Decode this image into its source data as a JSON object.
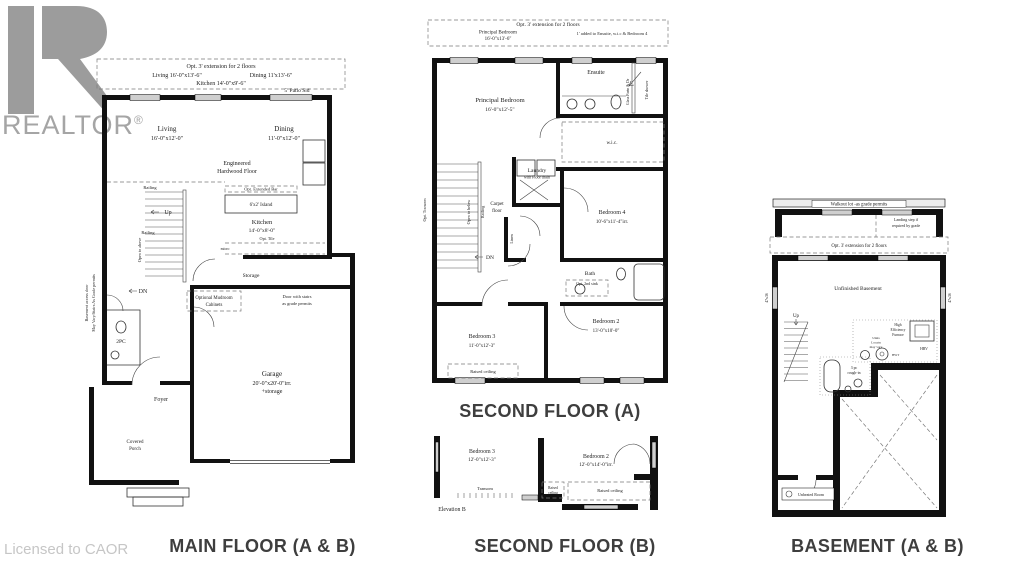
{
  "watermark": {
    "brand": "REALTOR",
    "reg": "®",
    "license": "Licensed to CAOR"
  },
  "captions": {
    "main": "MAIN FLOOR (A & B)",
    "second_a": "SECOND FLOOR (A)",
    "second_b": "SECOND FLOOR (B)",
    "basement": "BASEMENT (A & B)"
  },
  "main": {
    "opt_extension": "Opt. 3' extension for 2 floors",
    "opt_living": "Living 16'-0\"x13'-6\"",
    "opt_dining": "Dining 11'x13'-6\"",
    "opt_kitchen": "Kitchen 14'-0\"x9'-6\"",
    "patio": "5' Patio Sld",
    "living_name": "Living",
    "living_dim": "16'-0\"x12'-0\"",
    "dining_name": "Dining",
    "dining_dim": "11'-0\"x12'-0\"",
    "floor_1": "Engineered",
    "floor_2": "Hardwood Floor",
    "opt_bar": "Opt. Extended Bar",
    "island": "6'x2' Island",
    "kitchen_name": "Kitchen",
    "kitchen_dim": "14'-0\"x8'-0\"",
    "opt_tile": "Opt. Tile",
    "micro": "micro",
    "up": "Up",
    "dn": "DN",
    "railing_1": "Railing",
    "railing_2": "Railing",
    "open_above": "Open to above",
    "side_note_1": "Basement access door",
    "side_note_2": "May Vary/Stairs As Grade permits",
    "powder": "2PC",
    "mudroom_1": "Optional Mudroom",
    "mudroom_2": "Cabinets",
    "storage": "Storage",
    "door_note_1": "Door with stairs",
    "door_note_2": "as grade permits",
    "garage_name": "Garage",
    "garage_dim": "20'-0\"x20'-0\"irr.",
    "garage_dim2": "+storage",
    "foyer": "Foyer",
    "porch_1": "Covered",
    "porch_2": "Porch"
  },
  "second_a": {
    "opt_extension": "Opt. 3' extension for 2 floors",
    "opt_pb_1": "Principal Bedroom",
    "opt_pb_2": "16'-0\"x13'-6\"",
    "opt_added": "1' added to Ensuite, w.i.c & Bedroom 4",
    "principal_name": "Principal Bedroom",
    "principal_dim": "16'-0\"x12'-5\"",
    "ensuite": "Ensuite",
    "glass_partn": "Glass Partn & Dr",
    "tile_shower": "Tile shower",
    "wic": "w.i.c.",
    "laundry_1": "Laundry",
    "laundry_2": "with Floor drain",
    "carpet_1": "Carpet",
    "carpet_2": "floor",
    "open_below": "Open to below",
    "railing": "Railing",
    "linen": "Linen",
    "dn": "DN",
    "opt_transom": "Opt. Transom",
    "bed4_name": "Bedroom 4",
    "bed4_dim": "10'-6\"x11'-4\"irr.",
    "bath": "Bath",
    "opt_sink": "Opt. 2nd sink",
    "bed2_name": "Bedroom 2",
    "bed2_dim": "13'-0\"x10'-0\"",
    "bed3_name": "Bedroom 3",
    "bed3_dim": "11'-0\"x12'-3\"",
    "raised": "Raised ceiling"
  },
  "second_b": {
    "bed3_name": "Bedroom 3",
    "bed3_dim": "12'-0\"x12'-3\"",
    "bed2_name": "Bedroom 2",
    "bed2_dim": "12'-0\"x14'-0\"irr.",
    "transom": "Transom",
    "raised_1": "Raised",
    "raised_2": "ceiling",
    "raised_full": "Raised ceiling",
    "elevation": "Elevation B"
  },
  "basement": {
    "walkout": "Walkout lot -as grade permits",
    "landing_1": "Landing step if",
    "landing_2": "required by grade",
    "opt_extension": "Opt. 3' extension for 2 floors",
    "unfinished": "Unfinished Basement",
    "up": "Up",
    "window_left": "47x36",
    "window_right": "47x36",
    "furnace_1": "High",
    "furnace_2": "Efficiency",
    "furnace_3": "Furnace",
    "units_1": "Units",
    "units_2": "Locatn",
    "units_3": "may vary",
    "hwt": "HWT",
    "hrv": "HRV",
    "rough_1": "3 pc",
    "rough_2": "rough-in",
    "unheated": "Unheated Room"
  }
}
